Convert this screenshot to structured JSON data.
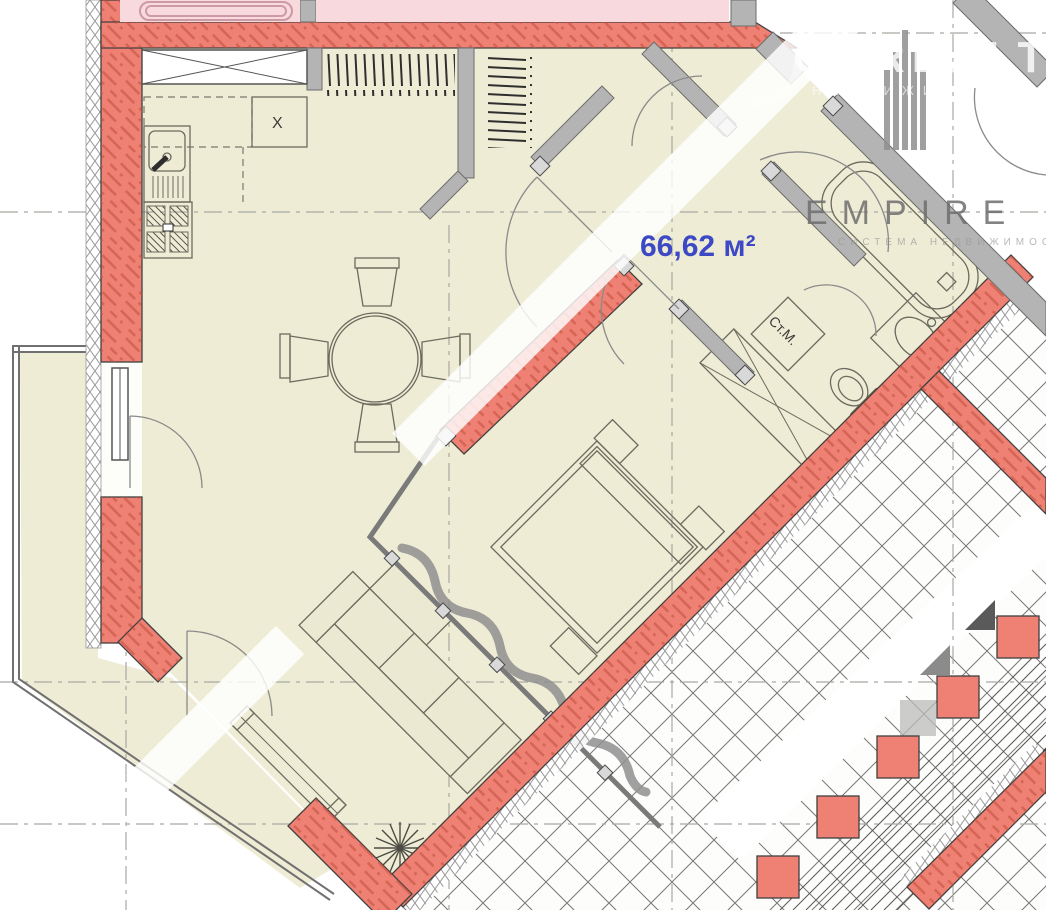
{
  "plan": {
    "area_label": "66,62 м²",
    "washer_label": "Ст.М.",
    "vent_label": "X"
  },
  "watermarks": {
    "onrealt": {
      "title": "ONREALT",
      "subtitle": "НЕДВИЖИМОСТЬ"
    },
    "empire": {
      "title": "EMPIRE",
      "subtitle": "СИСТЕМА НЕДВИЖИМОСТИ"
    }
  },
  "colors": {
    "wall_red": "#ee8173",
    "wall_hatch_red": "#c4513f",
    "floor_cream": "#efecd6",
    "adjacent_pink": "#f8d9de",
    "partition_gray": "#b4b4b4",
    "area_text_blue": "#3d49c4",
    "stair_line": "#565656"
  }
}
